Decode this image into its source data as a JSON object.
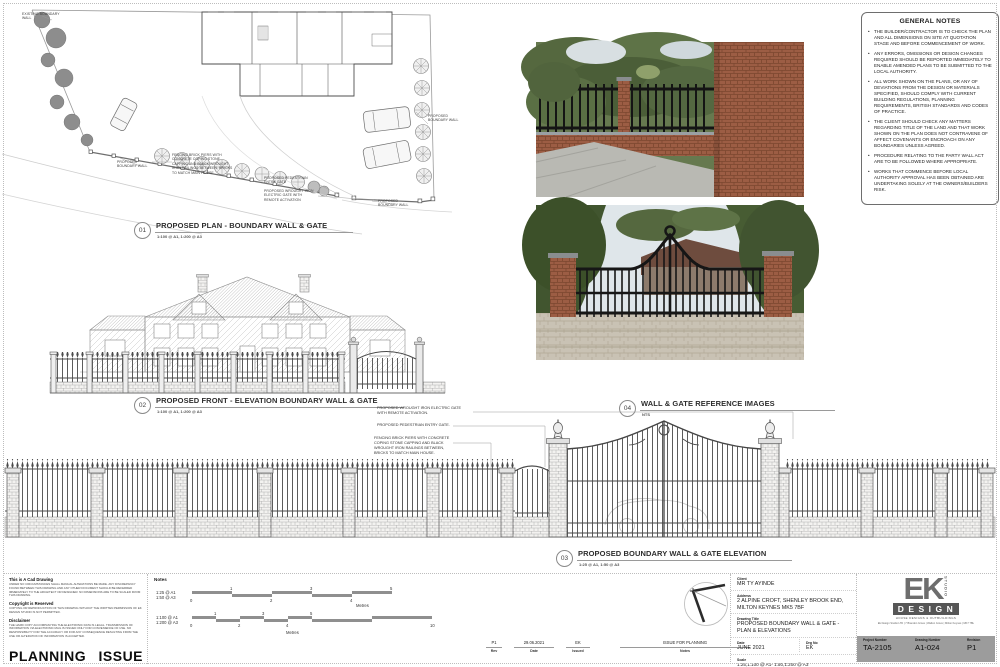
{
  "general_notes": {
    "title": "GENERAL NOTES",
    "items": [
      "THE BUILDER/CONTRACTOR IS TO CHECK THE PLAN AND ALL DIMENSIONS ON SITE AT QUOTATION STAGE AND BEFORE COMMENCEMENT OF WORK.",
      "ANY ERRORS, OMISSIONS OR DESIGN CHANGES REQUIRED SHOULD BE REPORTED IMMEDIATELY TO ENABLE AMENDED PLANS TO BE SUBMITTED TO THE LOCAL AUTHORITY.",
      "ALL WORK SHOWN ON THE PLANS, OR ANY OF DEVIATIONS FROM THE DESIGN OR MATERIALS SPECIFIED, SHOULD COMPLY WITH CURRENT BUILDING REGULATIONS, PLANNING REQUIREMENTS, BRITISH STANDARDS AND CODES OF PRACTICE.",
      "THE CLIENT SHOULD CHECK ANY MATTERS REGARDING TITLE OF THE LAND AND THAT WORK SHOWN ON THE PLAN DOES NOT CONTRAVENE OF AFFECT COVENANTS OR ENCROACH ON ANY BOUNDARIES UNLESS AGREED.",
      "PROCEDURE RELATING TO THE PARTY WALL ACT ARE TO BE FOLLOWED WHERE APPROPRIATE.",
      "WORKS THAT COMMENCE BEFORE LOCAL AUTHORITY APPROVAL HAS BEEN OBTAINED ARE UNDERTAKING SOLELY AT THE OWNERS/BUILDERS RISK."
    ]
  },
  "drawings": {
    "d01": {
      "number": "01",
      "title": "PROPOSED PLAN - BOUNDARY WALL & GATE",
      "scale": "1:100 @ A1, 1:200 @ A3"
    },
    "d02": {
      "number": "02",
      "title": "PROPOSED FRONT - ELEVATION BOUNDARY WALL & GATE",
      "scale": "1:100 @ A1, 1:200 @ A3"
    },
    "d03": {
      "number": "03",
      "title": "PROPOSED  BOUNDARY WALL & GATE ELEVATION",
      "scale": "1:25 @ A1, 1:50 @ A3"
    },
    "d04": {
      "number": "04",
      "title": "WALL & GATE REFERENCE IMAGES",
      "scale": "NTS"
    }
  },
  "plan_annotations": {
    "existing_boundary_wall": "EXISTING BOUNDARY WALL",
    "proposed_boundary_wall": "PROPOSED BOUNDARY WALL",
    "fencing_note": "FENCING BRICK PIERS WITH CONCRETE COPING STONE CAPPING AND BLACK WROUGHT IRON RAILINGS BETWEEN, BRICKS TO MATCH MAIN HOUSE",
    "pedestrian_gate": "PROPOSED  PEDESTRIAN ENTRY GATE",
    "electric_gate": "PROPOSED WROUGHT IRON ELECTRIC GATE WITH REMOTE ACTIVATION"
  },
  "elevation_annotations": {
    "electric_gate": "PROPOSED WROUGHT IRON ELECTRIC GATE WITH REMOTE ACTIVATION.",
    "pedestrian_gate": "PROPOSED  PEDESTRIAN ENTRY GATE.",
    "fencing_note": "FENCING BRICK PIERS WITH CONCRETE COPING STONE CAPPING AND BLACK WROUGHT IRON RAILINGS BETWEEN, BRICKS TO MATCH MAIN HOUSE."
  },
  "legal": {
    "cad_title": "This is A Cad Drawing",
    "cad_body": "UNDER NO CIRCUMSTANCES SHALL MANUAL ALTERATIONS BE MADE. ANY DISCREPANCY FOUND BETWEEN THIS DRAWING AND ANY OTHER DOCUMENT SHOULD BE REFERRED IMMEDIATELY TO THE ARCHITECT OR DESIGNER. NO DIMENSIONS ARE TO BE SCALED FROM THIS DRAWING.",
    "copyright_title": "Copyright is Reserved",
    "copyright_body": "COPYING OR REPRODUCTION OF THIS DRAWING WITHOUT THE WRITTEN PERMISSION OF EK DESIGN STUDIO IS NOT PERMITTED.",
    "disclaimer_title": "Disclaimer",
    "disclaimer_body": "THE HARD COPY ACCOMPANYING THE ELECTRONIC DATA IS LEGAL. TRANSMISSION OF INFORMATION VIA ELECTRONIC MAIL IS ISSUED ONLY FOR CONVENIENCE OF USE. NO RESPONSIBILITY FOR THE ACCURACY OR FOR ANY CONSEQUENCE RESULTING FROM THE USE OR ALTERATION OF INFORMATION IS ACCEPTED.",
    "stamp": "PLANNING ISSUE"
  },
  "notes_panel": {
    "label": "Notes",
    "bar1": {
      "a1": "1:25 @ A1",
      "a3": "1:50 @ A3",
      "unit": "Metres",
      "ticks": [
        "0",
        "1",
        "2",
        "3",
        "4",
        "5"
      ]
    },
    "bar2": {
      "a1": "1:100 @ A1",
      "a3": "1:200 @ A3",
      "unit": "Metres",
      "ticks": [
        "0",
        "1",
        "2",
        "3",
        "4",
        "5",
        "10"
      ]
    }
  },
  "revision_table": {
    "headers": {
      "rev": "Rev",
      "date": "Date",
      "issued": "Issued",
      "notes": "Notes"
    },
    "rows": [
      {
        "rev": "P1",
        "date": "29.06.2021",
        "issued": "EK",
        "notes": "ISSUE FOR PLANNING"
      }
    ]
  },
  "title_block": {
    "labels": {
      "client": "Client",
      "address": "Address",
      "drawing_title": "Drawing Title",
      "date": "Date",
      "drg_no": "Drg No",
      "scale": "Scale"
    },
    "client": "MR TY AYINDE",
    "address1": "2 ALPINE CROFT, SHENLEY BROOK END,",
    "address2": "MILTON KEYNES  MK5 7BF",
    "title1": "PROPOSED   BOUNDARY WALL & GATE -",
    "title2": "PLAN & ELEVATIONS",
    "date": "JUNE 2021",
    "drg_no": "EK",
    "scale": "1:25,1:100 @ A1- 1:50,1:200 @ A3"
  },
  "logo_block": {
    "letters": "EK",
    "studio": "STUDIO",
    "design": "DESIGN",
    "tagline": "HOUSE DESIGNS & OUTBUILDINGS",
    "address": "Ek Design Studio LTD | 7 Brandon Grove | Walton Grove | Milton Keynes | MK7 7BL",
    "fields": {
      "project_label": "Project Number",
      "project": "TA-2105",
      "drawing_label": "Drawing Number",
      "drawing": "A1-024",
      "revision_label": "Revision",
      "revision": "P1"
    }
  },
  "colors": {
    "line": "#6b6b6b",
    "brick_photo": "#9c5d44",
    "foliage": "#5a7244",
    "gate": "#161616",
    "bar_bg": "#9c9c9c"
  }
}
